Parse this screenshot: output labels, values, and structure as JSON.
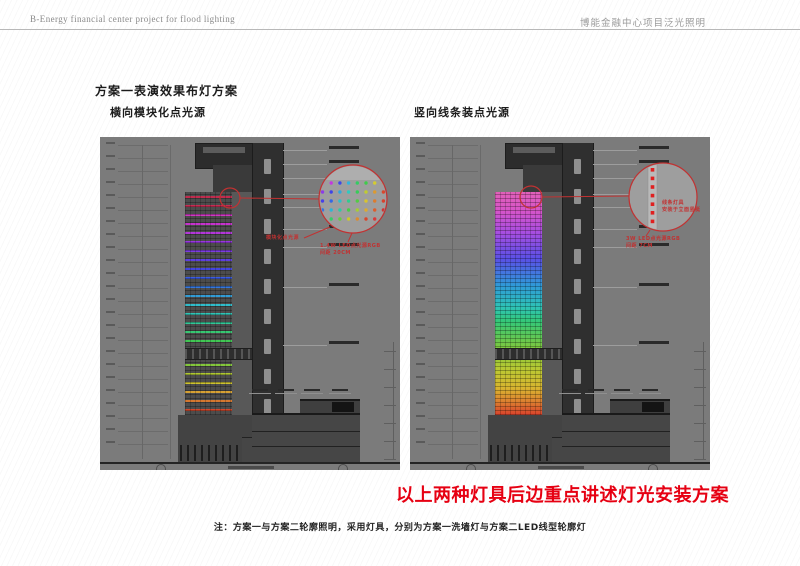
{
  "header": {
    "left": "B-Energy  financial center project for flood lighting",
    "right": "博能金融中心项目泛光照明"
  },
  "titles": {
    "main": "方案一表演效果布灯方案",
    "left_sub": "横向模块化点光源",
    "right_sub": "竖向线条装点光源"
  },
  "statement": "以上两种灯具后边重点讲述灯光安装方案",
  "note": "注：方案一与方案二轮廓照明，采用灯具，分别为方案一洗墙灯与方案二LED线型轮廓灯",
  "colors": {
    "statement_red": "#e60012",
    "annotation_red": "#c13232",
    "panel_bg": "#7b7b7b",
    "detail_circle_fill": "#9e9e9e"
  },
  "left_panel": {
    "label": "模块化点光源",
    "detail_caption1": "1.4W LED点光源RGB",
    "detail_caption2": "间距 20CM",
    "stripes": [
      {
        "y": 4,
        "c": "#c62a4e"
      },
      {
        "y": 13,
        "c": "#cc2a52"
      },
      {
        "y": 22,
        "c": "#d636c8"
      },
      {
        "y": 31,
        "c": "#cc32d4"
      },
      {
        "y": 40,
        "c": "#b836e0"
      },
      {
        "y": 49,
        "c": "#9a36e6"
      },
      {
        "y": 58,
        "c": "#7e3ae8"
      },
      {
        "y": 67,
        "c": "#5f3ee8"
      },
      {
        "y": 76,
        "c": "#4446e8"
      },
      {
        "y": 85,
        "c": "#3a5ce8"
      },
      {
        "y": 94,
        "c": "#3478e4"
      },
      {
        "y": 103,
        "c": "#30a0dc"
      },
      {
        "y": 112,
        "c": "#2ec2d2"
      },
      {
        "y": 121,
        "c": "#2ecabc"
      },
      {
        "y": 130,
        "c": "#30cc9a"
      },
      {
        "y": 139,
        "c": "#36cc74"
      },
      {
        "y": 148,
        "c": "#40cc54"
      },
      {
        "y": 172,
        "c": "#86cc3a"
      },
      {
        "y": 181,
        "c": "#b4cc32"
      },
      {
        "y": 190,
        "c": "#d4c82e"
      },
      {
        "y": 199,
        "c": "#dca432"
      },
      {
        "y": 208,
        "c": "#dc7a2e"
      },
      {
        "y": 217,
        "c": "#d8482a"
      }
    ],
    "dot_rows": [
      [
        "#d83ad8",
        "#c438e0",
        "#3c48e8",
        "#32b4dc",
        "#34cc62",
        "#3ecc4a",
        "#d4cc30",
        "#dc9232"
      ],
      [
        "#8c3ce8",
        "#4044e8",
        "#30a8dc",
        "#2ecac0",
        "#38cc58",
        "#c0cc30",
        "#dc9a30",
        "#d8482c"
      ],
      [
        "#4840e8",
        "#3468e6",
        "#2ec0cc",
        "#30cc8e",
        "#52cc44",
        "#d8c42e",
        "#dc7c2e",
        "#d8422c"
      ],
      [
        "#3474e4",
        "#2eb6d4",
        "#2ecaa6",
        "#48cc48",
        "#a6cc36",
        "#dcaa30",
        "#dc5e2c",
        "#d23232"
      ],
      [
        "#d8382c",
        "#34cc6a",
        "#66cc40",
        "#ccc82e",
        "#dc8c30",
        "#d8462c",
        "#d83a3a",
        "#cc3060"
      ]
    ]
  },
  "right_panel": {
    "detail_label1": "线条灯具",
    "detail_label2": "安装于立面竖梃",
    "detail_caption1": "3W LED点光源RGB",
    "detail_caption2": "间距 7CM",
    "strip_dot_color": "#e02020",
    "gradient_stops": [
      [
        0,
        "#e060b8"
      ],
      [
        8,
        "#d855c8"
      ],
      [
        18,
        "#a84ee0"
      ],
      [
        30,
        "#5a50e6"
      ],
      [
        42,
        "#2f9ad8"
      ],
      [
        52,
        "#2ec4b4"
      ],
      [
        58,
        "#34c878"
      ],
      [
        70,
        "#7ec83e"
      ],
      [
        80,
        "#bcc832"
      ],
      [
        88,
        "#d8b430"
      ],
      [
        94,
        "#dc8030"
      ],
      [
        100,
        "#d8422c"
      ]
    ]
  }
}
